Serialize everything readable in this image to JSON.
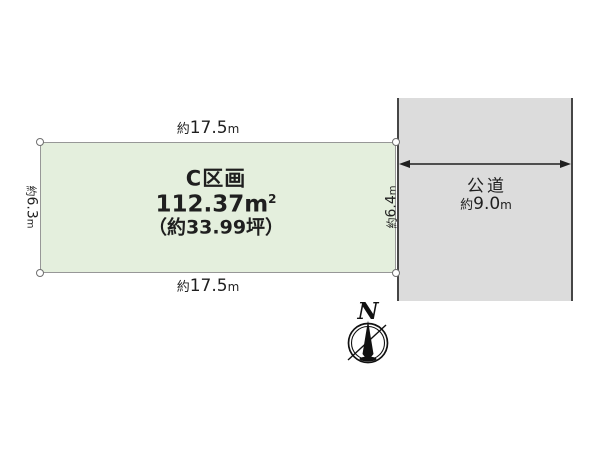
{
  "diagram": {
    "plot": {
      "title": "C区画",
      "area_value": "112.37",
      "area_unit": "m",
      "area_sup": "2",
      "area_tsubo": "（約33.99坪）",
      "fill": "#e4efdd",
      "border_color": "#979797",
      "dims": {
        "top": {
          "prefix": "約",
          "value": "17.5",
          "unit": "m"
        },
        "bottom": {
          "prefix": "約",
          "value": "17.5",
          "unit": "m"
        },
        "left": {
          "prefix": "約",
          "value": "6.3",
          "unit": "m"
        },
        "right": {
          "prefix": "約",
          "value": "6.4",
          "unit": "m"
        }
      }
    },
    "road": {
      "label": "公道",
      "dim": {
        "prefix": "約",
        "value": "9.0",
        "unit": "m"
      },
      "fill": "#dcdcdc",
      "border_color": "#464646"
    },
    "compass": {
      "north_label": "N"
    },
    "text_color": "#1f1f1f"
  }
}
